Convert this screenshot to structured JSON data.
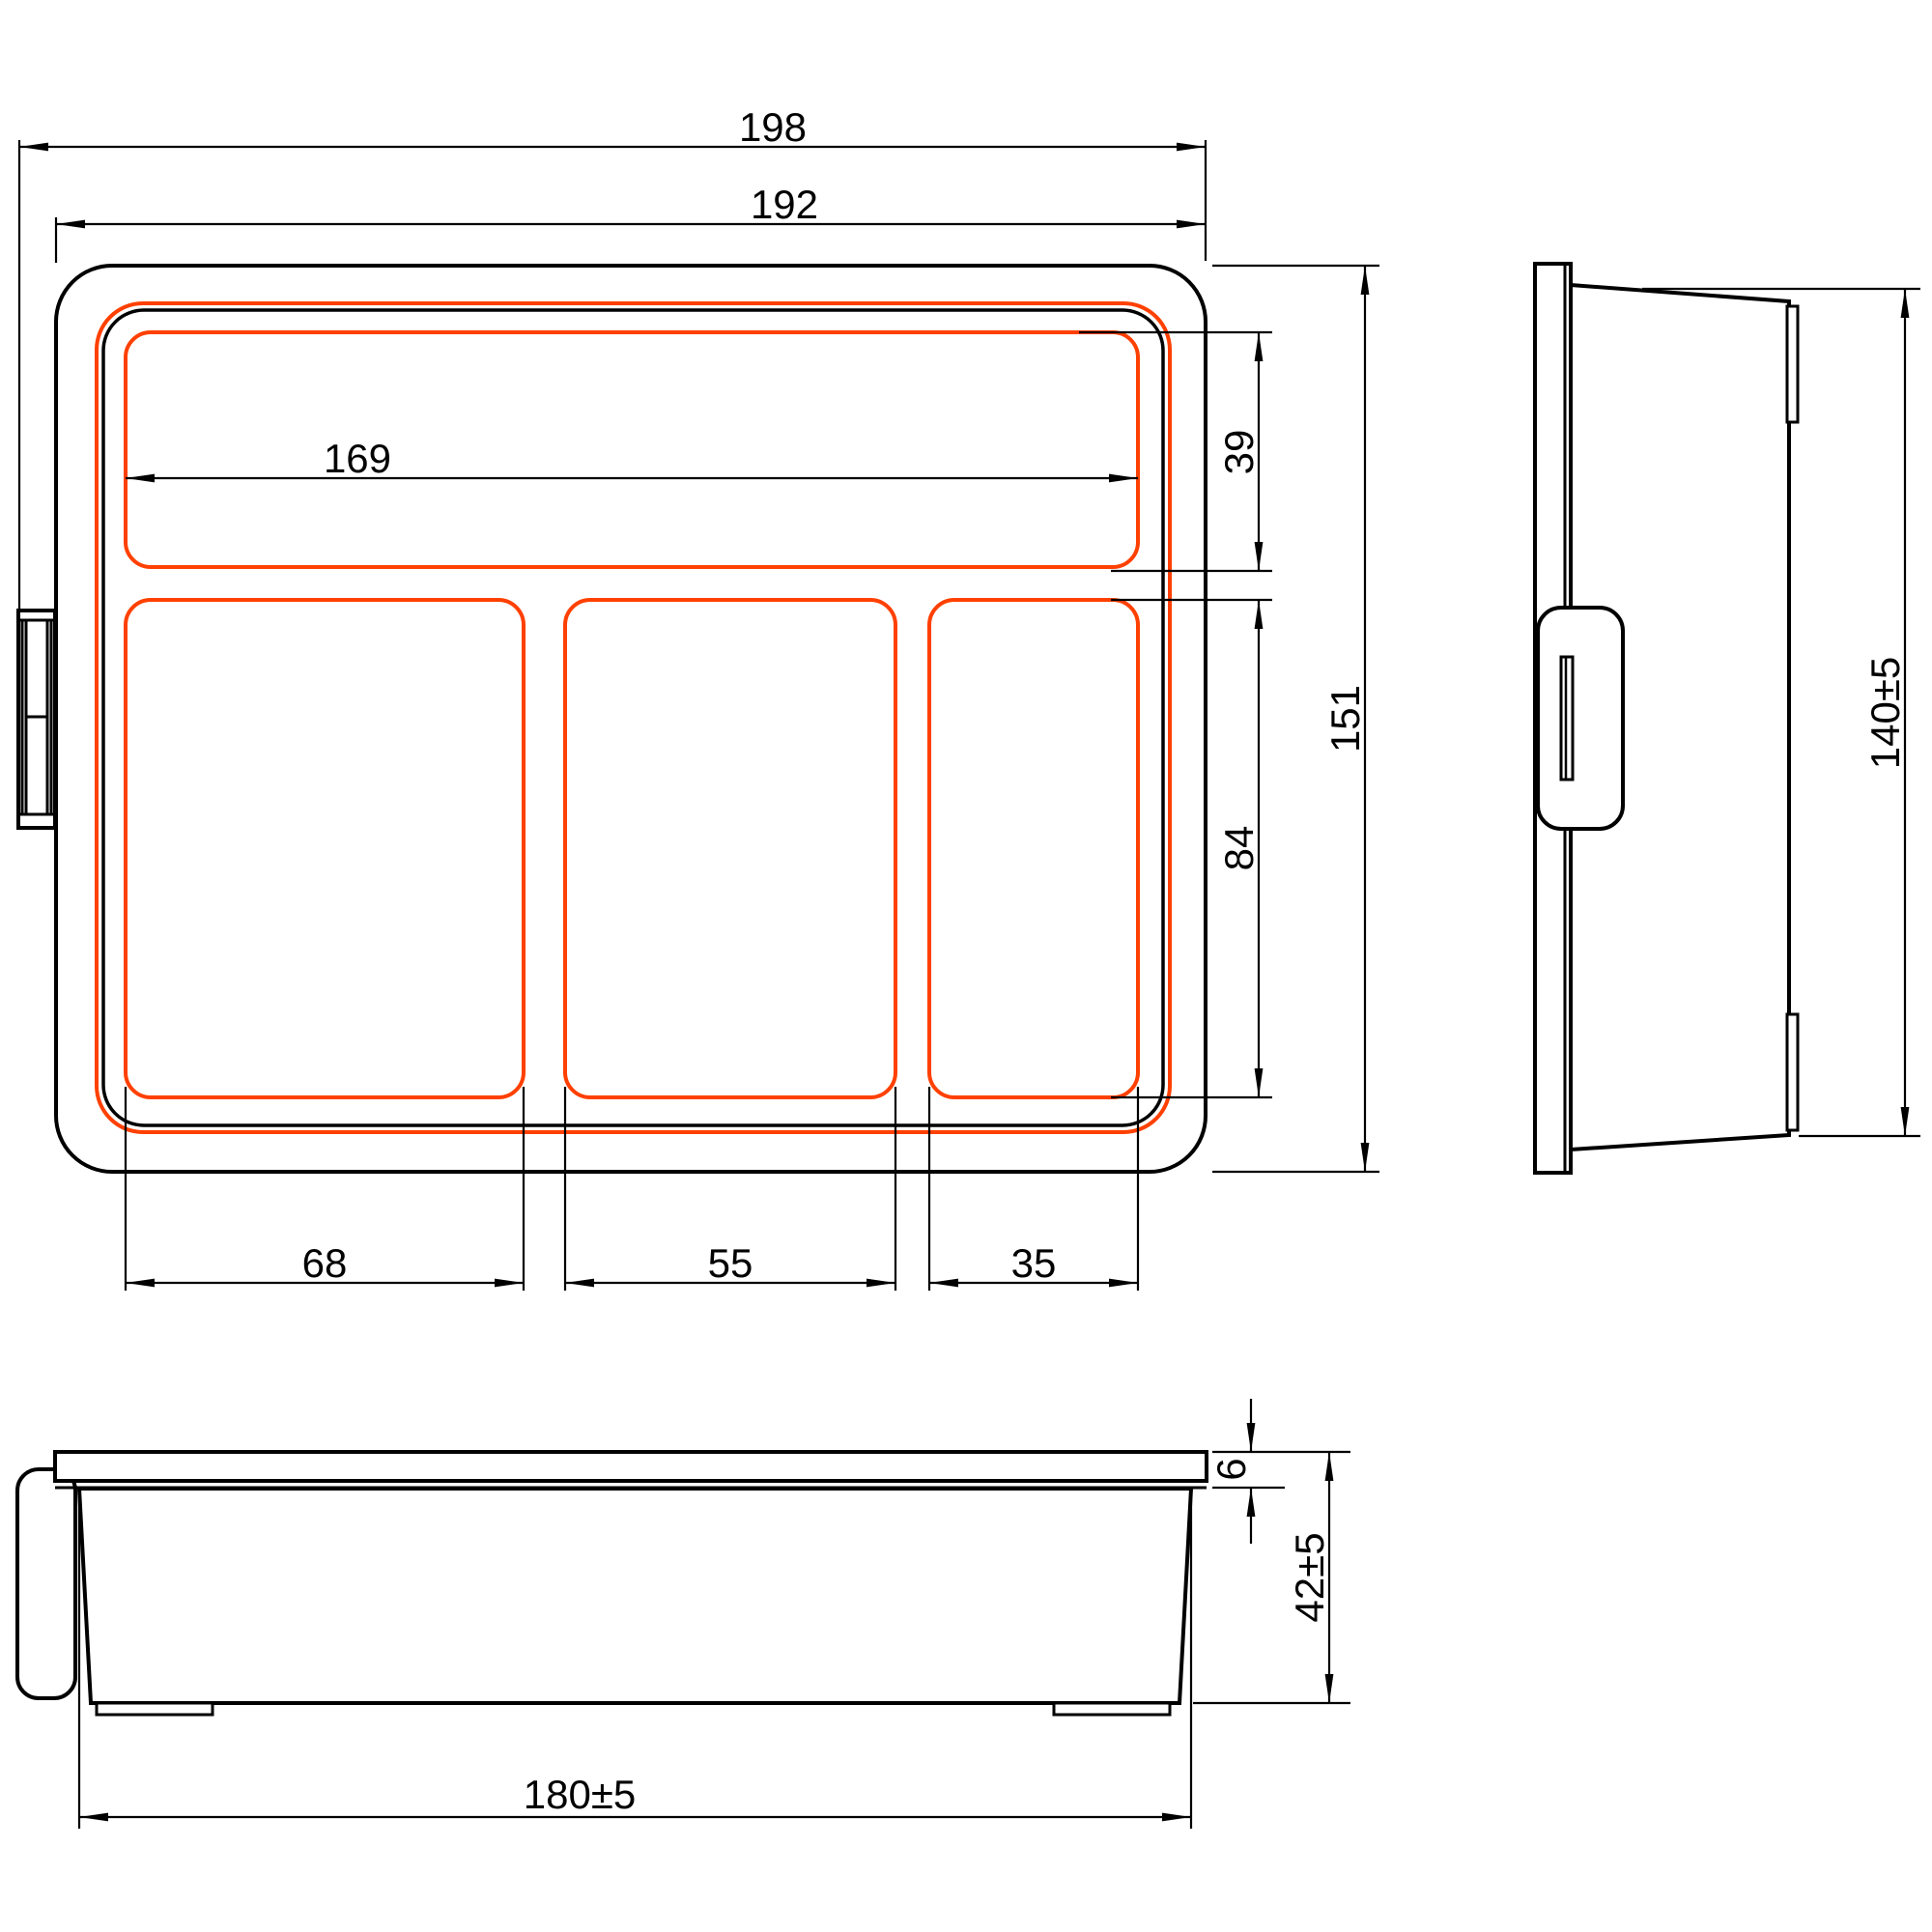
{
  "drawing_type": "technical-drawing-3-view-compartment-tray",
  "colors": {
    "line": "#000000",
    "highlight": "#FF4000",
    "background": "#FFFFFF"
  },
  "dimensions": {
    "overall_width": "198",
    "lid_width": "192",
    "inner_width": "169",
    "top_compartment_depth": "39",
    "main_compartment_depth": "84",
    "overall_depth": "151",
    "compartment1_width": "68",
    "compartment2_width": "55",
    "compartment3_width": "35",
    "side_body_height": "140±5",
    "lid_thickness": "6",
    "tray_height": "42±5",
    "tray_bottom_width": "180±5"
  }
}
